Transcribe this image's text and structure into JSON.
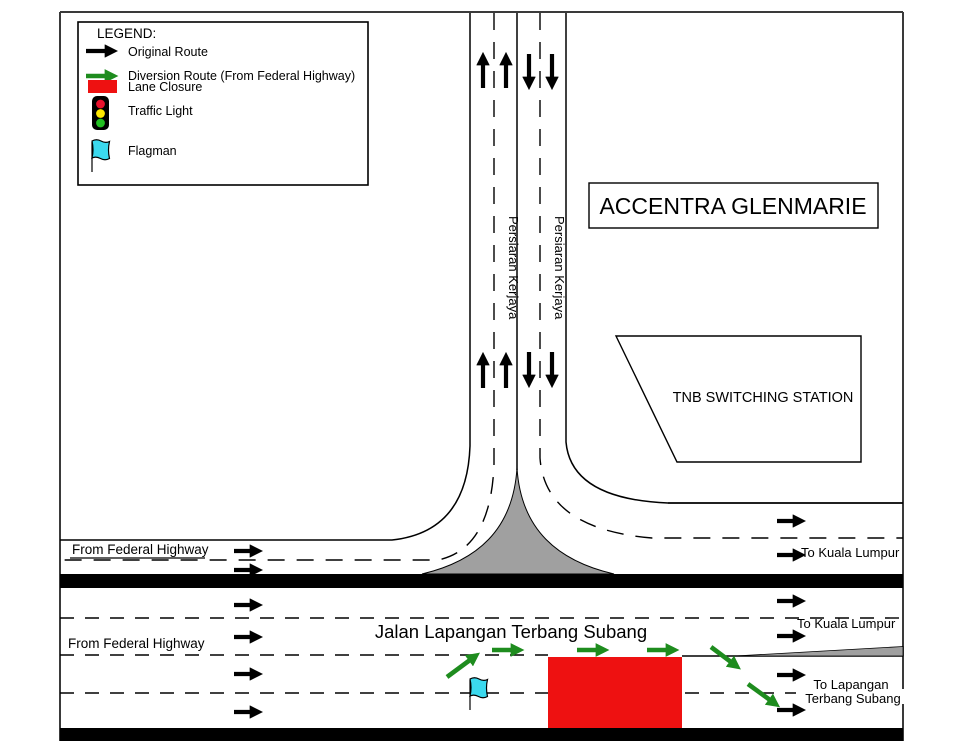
{
  "legend": {
    "title": "LEGEND:",
    "items": [
      {
        "label": "Original Route",
        "swatch": "black-arrow"
      },
      {
        "label": "Diversion Route (From Federal Highway)",
        "swatch": "green-arrow"
      },
      {
        "label": "Lane Closure",
        "swatch": "red-rect"
      },
      {
        "label": "Traffic Light",
        "swatch": "traffic-light"
      },
      {
        "label": "Flagman",
        "swatch": "flag"
      }
    ]
  },
  "places": {
    "accentra": "ACCENTRA GLENMARIE",
    "tnb": "TNB SWITCHING STATION"
  },
  "roads": {
    "persiaran_kerjaya": "Persiaran Kerjaya",
    "jalan_lapangan": "Jalan Lapangan Terbang Subang"
  },
  "directions": {
    "from_federal_highway": "From Federal Highway",
    "to_kuala_lumpur": "To Kuala Lumpur",
    "to_lapangan_1": "To Lapangan",
    "to_lapangan_2": "Terbang Subang"
  },
  "colors": {
    "original_route": "#000000",
    "diversion_route": "#1E8C1E",
    "lane_closure": "#EE1111",
    "flagman": "#3BD9EE",
    "island": "#A0A0A0",
    "traffic_red": "#E8112D",
    "traffic_amber": "#FFE800",
    "traffic_green": "#22C022"
  }
}
